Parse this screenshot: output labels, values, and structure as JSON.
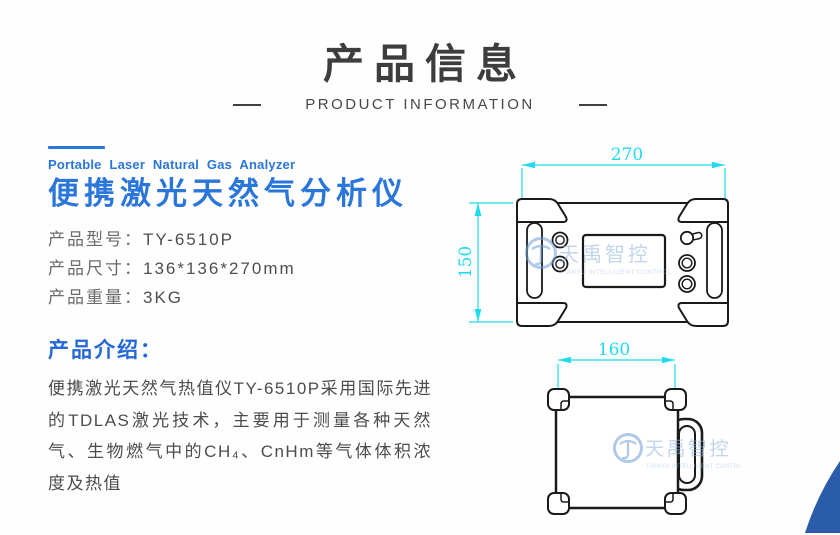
{
  "header": {
    "title": "产品信息",
    "subtitle": "PRODUCT INFORMATION"
  },
  "product": {
    "eyebrow_en": "Portable Laser Natural Gas Analyzer",
    "title_zh": "便携激光天然气分析仪",
    "specs": [
      {
        "label": "产品型号：",
        "value": "TY-6510P"
      },
      {
        "label": "产品尺寸：",
        "value": "136*136*270mm"
      },
      {
        "label": "产品重量：",
        "value": "3KG"
      }
    ],
    "intro_heading": "产品介绍：",
    "intro_text": "便携激光天然气热值仪TY-6510P采用国际先进的TDLAS激光技术，主要用于测量各种天然气、生物燃气中的CH₄、CnHm等气体体积浓度及热值"
  },
  "drawings": {
    "front_view": {
      "width_label": "270",
      "height_label": "150"
    },
    "side_view": {
      "width_label": "160"
    },
    "watermark": {
      "brand": "天禹智控",
      "brand_en": "TIANYU INTELLIGENT CONTROL"
    }
  },
  "colors": {
    "accent_blue": "#2b76d9",
    "dimension_cyan": "#1fdbed",
    "corner_blue": "#2b5ca9",
    "heading_gray": "#3d3d3d",
    "watermark_blue": "#8fb3dd"
  }
}
